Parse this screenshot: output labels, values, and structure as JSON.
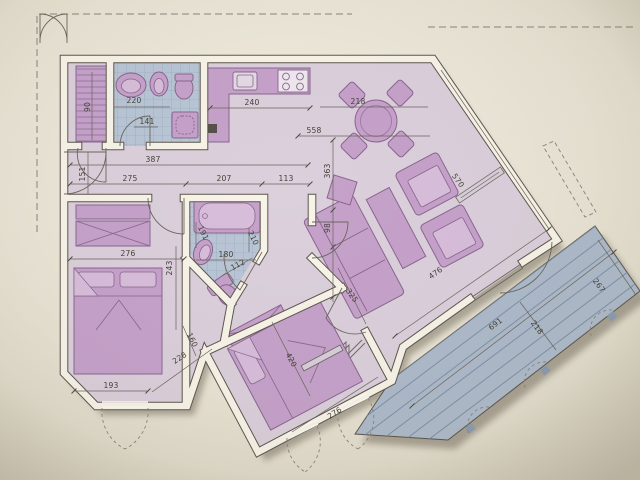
{
  "document": {
    "kind": "apartment-floor-plan-photo",
    "paper_color": "#e9e4d5",
    "palette": {
      "wall_fill": "#f8f4e9",
      "wall_line": "#5c564c",
      "floor": "#dbd0dc",
      "furniture": "#c6a2cb",
      "furniture_outline": "#8a6690",
      "bathroom_floor": "#b9c6d6",
      "terrace": "#aebbcb",
      "dimension_text": "#45413a"
    }
  },
  "dims": {
    "closet_depth": "90",
    "bath1_width": "220",
    "bath1_door": "141",
    "kitchen_run": "240",
    "hall_length": "387",
    "entry_side": "151",
    "bed1_top": "275",
    "bath2_top": "207",
    "corridor_top": "113",
    "living_width": "558",
    "dining_depth": "363",
    "dining_width": "218",
    "living_step": "98",
    "living_diag_wall": "570",
    "living_se_width": "476",
    "living_se_depth": "325",
    "bed1_width": "276",
    "bed1_depth": "243",
    "bed1_bottom": "193",
    "bed1_corner": "228",
    "bed1_side": "160",
    "bath2_width": "180",
    "bath2_depth": "210",
    "bath2_diag": "112",
    "bath2_side": "191",
    "bed2_length": "420",
    "bed2_width": "276",
    "terrace_length": "691",
    "terrace_width": "218",
    "terrace_side": "267"
  }
}
